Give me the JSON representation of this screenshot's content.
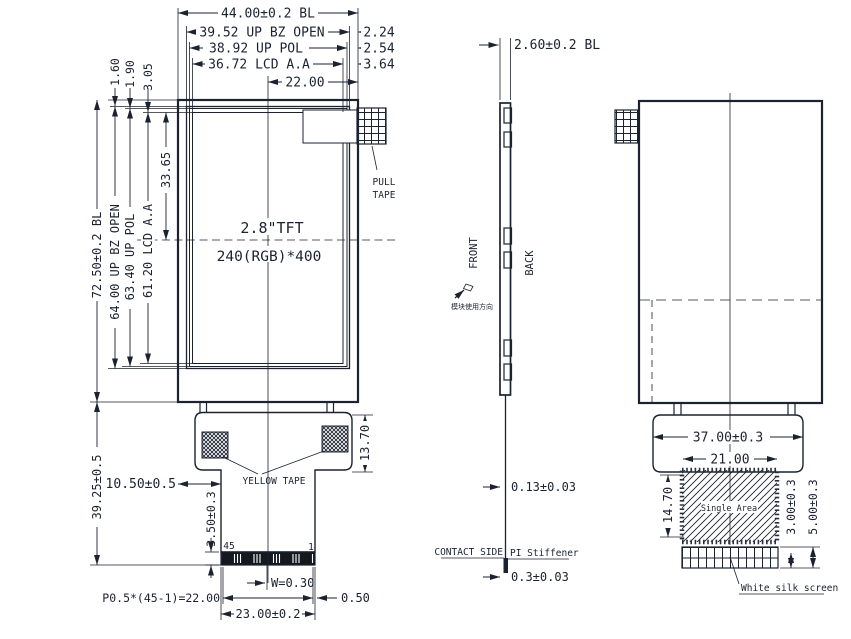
{
  "drawing": {
    "front": {
      "dim_bl_w": "44.00±0.2 BL",
      "dim_bz_w": "39.52 UP BZ OPEN",
      "dim_pol_w": "38.92 UP POL",
      "dim_aa_w": "36.72 LCD A.A",
      "dim_half_w": "22.00",
      "dim_bz_right": "2.24",
      "dim_pol_right": "2.54",
      "dim_aa_right": "3.64",
      "dim_bz_top": "1.60",
      "dim_pol_top": "1.90",
      "dim_aa_top": "3.05",
      "dim_bl_h": "72.50±0.2 BL",
      "dim_bz_h": "64.00 UP BZ OPEN",
      "dim_pol_h": "63.40 UP POL",
      "dim_aa_h": "61.20 LCD A.A",
      "dim_center_v": "33.65",
      "panel_size": "2.8\"TFT",
      "panel_res": "240(RGB)*400",
      "pull_tape_1": "PULL",
      "pull_tape_2": "TAPE",
      "yellow_tape": "YELLOW TAPE",
      "dim_tail_left": "10.50±0.5",
      "dim_tail_h": "39.25±0.5",
      "dim_shoulder_h": "13.70",
      "dim_conn_h": "3.50±0.3",
      "pin_num_left": "45",
      "pin_num_right": "1",
      "dim_pin_w": "W=0.30",
      "dim_pitch": "P0.5*(45-1)=22.00",
      "dim_pin_margin": "0.50",
      "dim_conn_w": "23.00±0.2"
    },
    "side": {
      "dim_thickness": "2.60±0.2 BL",
      "front_label": "FRONT",
      "back_label": "BACK",
      "orientation_note": "模块使用方向",
      "dim_fpc_thickness": "0.13±0.03",
      "contact_side_label": "CONTACT SIDE",
      "stiffener_label": "PI Stiffener",
      "dim_stiffener_thickness": "0.3±0.03"
    },
    "back": {
      "dim_shoulder_w": "37.00±0.3",
      "dim_single_area_w": "21.00",
      "dim_single_area_h": "14.70",
      "single_area_label": "Single Area",
      "dim_silk_a": "3.00±0.3",
      "dim_silk_b": "5.00±0.3",
      "silk_screen_label": "White silk screen"
    },
    "line_color": "#1b2230"
  }
}
